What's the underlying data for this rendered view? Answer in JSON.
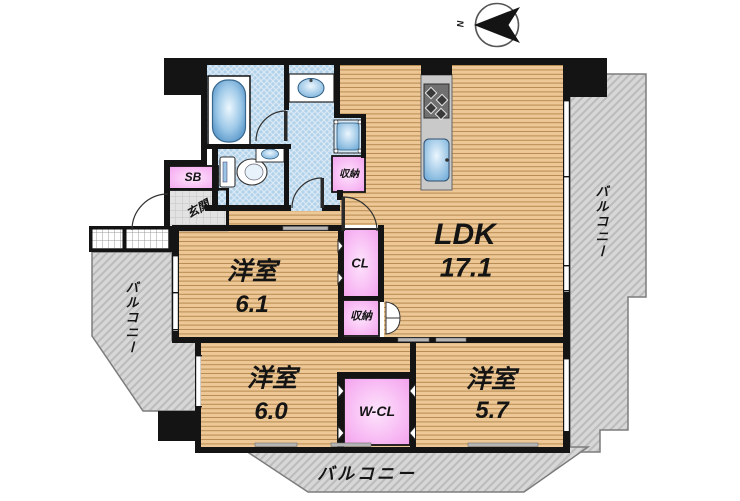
{
  "plan": {
    "compass": {
      "north": "N"
    },
    "rooms": [
      {
        "id": "ldk",
        "name": "LDK",
        "size": "17.1"
      },
      {
        "id": "bedroom-61",
        "name": "洋室",
        "size": "6.1"
      },
      {
        "id": "bedroom-60",
        "name": "洋室",
        "size": "6.0"
      },
      {
        "id": "bedroom-57",
        "name": "洋室",
        "size": "5.7"
      }
    ],
    "labels": {
      "entrance": "玄関",
      "shoe_box": "SB",
      "closet": "CL",
      "storage_upper": "収納",
      "storage_mid": "収納",
      "walk_in_closet": "W-CL",
      "balcony_right": "バルコニー",
      "balcony_left": "バルコニー",
      "balcony_bottom": "バルコニー"
    },
    "colors": {
      "wood_floor": "#edc795",
      "wood_stripe": "#b78b51",
      "wet_area_blue": "#b2d2ea",
      "closet_pink": "#f6aef1",
      "balcony_gray": "#d7d7d7",
      "entrance_tile": "#e2e2e2",
      "wall_black": "#141414"
    }
  }
}
